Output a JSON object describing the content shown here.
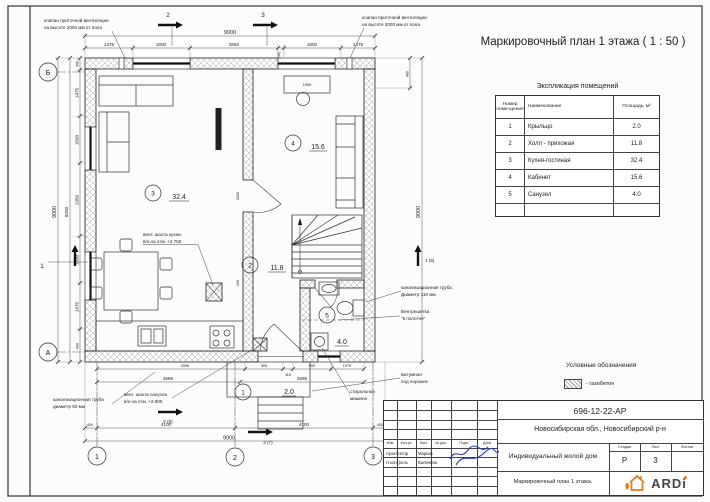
{
  "sheet": {
    "title": "Маркировочный план 1 этажа ( 1 : 50 )"
  },
  "explication": {
    "title": "Экспликация помещений",
    "columns": {
      "num": "Номер поме-щения",
      "name": "Наименование",
      "area": "Площадь, м²"
    },
    "rows": [
      {
        "num": "1",
        "name": "Крыльцо",
        "area": "2.0"
      },
      {
        "num": "2",
        "name": "Холл - прихожая",
        "area": "11.8"
      },
      {
        "num": "3",
        "name": "Кухня-гостиная",
        "area": "32.4"
      },
      {
        "num": "4",
        "name": "Кабинет",
        "area": "15.6"
      },
      {
        "num": "5",
        "name": "Санузел",
        "area": "4.0"
      }
    ]
  },
  "legend": {
    "title": "Условные обозначения",
    "gazobeton": "- газобетон"
  },
  "plan": {
    "axes": {
      "row_top": "Б",
      "row_bottom": "А",
      "col_1": "1",
      "col_2": "2",
      "col_3": "3"
    },
    "sections": {
      "top_2": "2",
      "top_3": "3",
      "left_1": "1",
      "right_1": "1 (5)",
      "bottom_2": "2 (6)",
      "bottom_3": "3 (7)"
    },
    "rooms": {
      "r1": {
        "num": "1",
        "area": "2.0"
      },
      "r2": {
        "num": "2",
        "area": "11.8"
      },
      "r3": {
        "num": "3",
        "area": "32.4"
      },
      "r4": {
        "num": "4",
        "area": "15.6"
      },
      "r5": {
        "num": "5",
        "area": "4.0"
      }
    },
    "labels": {
      "vent_valve_l1": "клапан приточной вентиляции",
      "vent_valve_l2": "на высоте 2000 мм от пола",
      "vent_kitchen_l1": "вент. шахта кухни",
      "vent_kitchen_l2": "в/о на отм. +2.750",
      "sewer110_l1": "канализационная труба",
      "sewer110_l2": "Диаметр 110 мм",
      "grille_l1": "Вентрешетка",
      "grille_l2": "\"в полотне\"",
      "sewer50_l1": "канализационная труба",
      "sewer50_l2": "диаметр 50 мм",
      "vent_wc_l1": "вент. шахта санузла",
      "vent_wc_l2": "в/о на отм. +2.900",
      "washer_l1": "стиральная",
      "washer_l2": "машина",
      "bitumen_l1": "Битумная",
      "bitumen_l2": "под порожек"
    },
    "dims": {
      "top_overall": "9000",
      "top": [
        "1475",
        "1800",
        "2650",
        "(40)",
        "1800",
        "1475"
      ],
      "left_overall": "9000",
      "left_inner": "8200",
      "left": [
        "400",
        "1475",
        "1500",
        "2350",
        "1500",
        "1475",
        "400"
      ],
      "right_overall": "9000",
      "right_480": "480",
      "bottom_r1": [
        "2095",
        "300",
        "115",
        "900",
        "1075"
      ],
      "bottom_r2": [
        "4585",
        "2695"
      ],
      "bottom_r3": [
        "400",
        "4100",
        "4100",
        "400"
      ],
      "bottom_overall": "9000",
      "desk": "1950",
      "opening": "2000",
      "opening2": "400"
    }
  },
  "titleblock": {
    "doc_number": "696-12-22-АР",
    "location": "Новосибирская обл., Новосибирский р-н",
    "object": "Индивидуальный жилой дом",
    "drawing_name": "Маркировочный план 1 этажа.",
    "cols": [
      "Изм.",
      "Кол.уч.",
      "Лист",
      "№ док.",
      "Подп.",
      "Дата"
    ],
    "rows": [
      {
        "role": "Архитектор",
        "name": "Марков"
      },
      {
        "role": "Н.контроль",
        "name": "Баленева"
      }
    ],
    "stage_label": "Стадия",
    "sheet_label": "Лист",
    "sheets_label": "Листов",
    "stage": "Р",
    "sheet_num": "3",
    "logo": "ARDi"
  }
}
